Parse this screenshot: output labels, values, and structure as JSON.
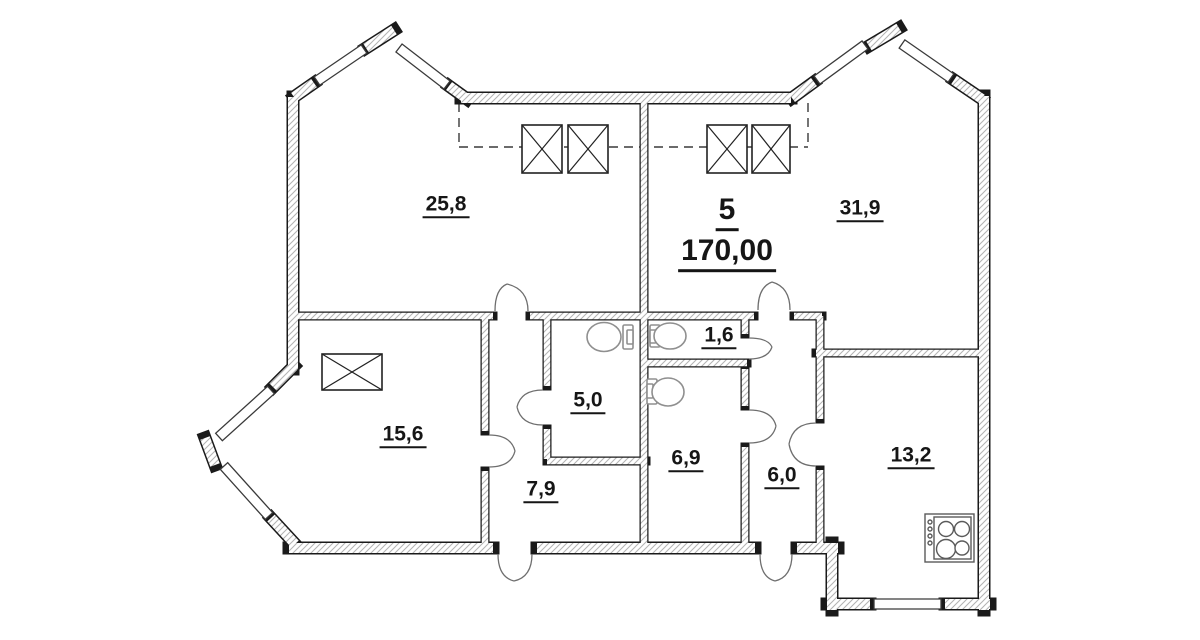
{
  "page": {
    "type": "apartment floor plan drawing",
    "background": "#ffffff"
  },
  "apartment": {
    "number": "5",
    "total_area_m2": "170,00"
  },
  "rooms": [
    {
      "key": "room-top-left",
      "area": "25,8"
    },
    {
      "key": "room-top-right",
      "area": "31,9"
    },
    {
      "key": "room-left",
      "area": "15,6"
    },
    {
      "key": "kitchen",
      "area": "13,2"
    },
    {
      "key": "hall-left",
      "area": "7,9"
    },
    {
      "key": "bathroom-large",
      "area": "6,9"
    },
    {
      "key": "hall-right",
      "area": "6,0"
    },
    {
      "key": "bathroom-small",
      "area": "5,0"
    },
    {
      "key": "wc-lobby",
      "area": "1,6"
    }
  ],
  "fixtures": {
    "ventilation_shaft_count": 5,
    "toilet_count": 3,
    "stove_count": 1,
    "icon_names": [
      "ventilation-shaft-icon",
      "toilet-icon",
      "stove-icon",
      "door-swing-icon",
      "window-icon"
    ]
  },
  "colors": {
    "wall_outline": "#1a1a1a",
    "wall_hatch": "#b3b3b3",
    "fixture_gray": "#8f8f8f",
    "text": "#161616",
    "background": "#ffffff"
  }
}
